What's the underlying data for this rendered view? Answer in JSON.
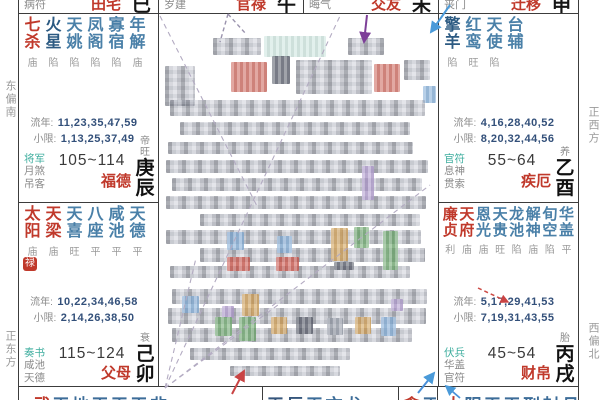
{
  "labels": {
    "liunian": "流年:",
    "xiaoxian": "小限:"
  },
  "directions": {
    "top_left": "东偏南",
    "bottom_left": "正东方",
    "top_right": "正西方",
    "bottom_right": "西偏北"
  },
  "top_row": [
    {
      "god": "病符",
      "palace": "田宅",
      "branch": "巳"
    },
    {
      "god": "岁建",
      "palace": "官禄",
      "branch": "午"
    },
    {
      "god": "晦气",
      "palace": "交友",
      "branch": "未"
    },
    {
      "god": "丧门",
      "palace": "迁移",
      "branch": "申"
    }
  ],
  "palaces": {
    "fude": {
      "stars": [
        {
          "n": "七杀",
          "b": "庙"
        },
        {
          "n": "火星",
          "b": "陷"
        },
        {
          "n": "天姚",
          "b": "陷"
        },
        {
          "n": "凤阁",
          "b": "陷"
        },
        {
          "n": "寡宿",
          "b": "陷"
        },
        {
          "n": "年解",
          "b": "庙"
        }
      ],
      "liunian": "11,23,35,47,59",
      "xiaoxian": "1,13,25,37,49",
      "gods": [
        "将军",
        "月煞",
        "吊客"
      ],
      "age": "105~114",
      "name": "福德",
      "stage": "帝旺",
      "stem": "庚辰"
    },
    "jie": {
      "stars": [
        {
          "n": "擎羊",
          "b": "陷"
        },
        {
          "n": "红鸾",
          "b": "旺"
        },
        {
          "n": "天使",
          "b": "陷"
        },
        {
          "n": "台辅",
          "b": ""
        }
      ],
      "liunian": "4,16,28,40,52",
      "xiaoxian": "8,20,32,44,56",
      "gods": [
        "官符",
        "息神",
        "贯索"
      ],
      "age": "55~64",
      "name": "疾厄",
      "stage": "养",
      "stem": "乙酉"
    },
    "fumu": {
      "stars": [
        {
          "n": "太阳",
          "b": "庙"
        },
        {
          "n": "天梁",
          "b": "庙"
        },
        {
          "n": "天喜",
          "b": "旺"
        },
        {
          "n": "八座",
          "b": "平"
        },
        {
          "n": "咸池",
          "b": "平"
        },
        {
          "n": "天德",
          "b": "平"
        }
      ],
      "hua": "禄",
      "liunian": "10,22,34,46,58",
      "xiaoxian": "2,14,26,38,50",
      "gods": [
        "奏书",
        "咸池",
        "天德"
      ],
      "age": "115~124",
      "name": "父母",
      "stage": "衰",
      "stem": "己卯"
    },
    "caibo": {
      "stars": [
        {
          "n": "廉贞",
          "b": "利"
        },
        {
          "n": "天府",
          "b": "庙"
        },
        {
          "n": "恩光",
          "b": "庙"
        },
        {
          "n": "天贵",
          "b": "旺"
        },
        {
          "n": "龙池",
          "b": "陷"
        },
        {
          "n": "解神",
          "b": "庙"
        },
        {
          "n": "旬空",
          "b": "陷"
        },
        {
          "n": "华盖",
          "b": "平"
        }
      ],
      "liunian": "5,17,29,41,53",
      "xiaoxian": "7,19,31,43,55",
      "gods": [
        "伏兵",
        "华盖",
        "官符"
      ],
      "age": "45~54",
      "name": "财帛",
      "stage": "胎",
      "stem": "丙戌"
    }
  },
  "bottom_row": [
    {
      "first": "武",
      "rest": "天地天天天非"
    },
    {
      "first": "天巨",
      "rest": "天文龙"
    },
    {
      "first": "贪",
      "rest": "天"
    },
    {
      "first": "太",
      "rest": "阴天天刑封月"
    }
  ],
  "colors": {
    "major_star": "#c0392b",
    "minor_star": "#4a80a8",
    "god_accent": "#3fae9f",
    "palace_name": "#c0392b",
    "numbers": "#33507a"
  }
}
